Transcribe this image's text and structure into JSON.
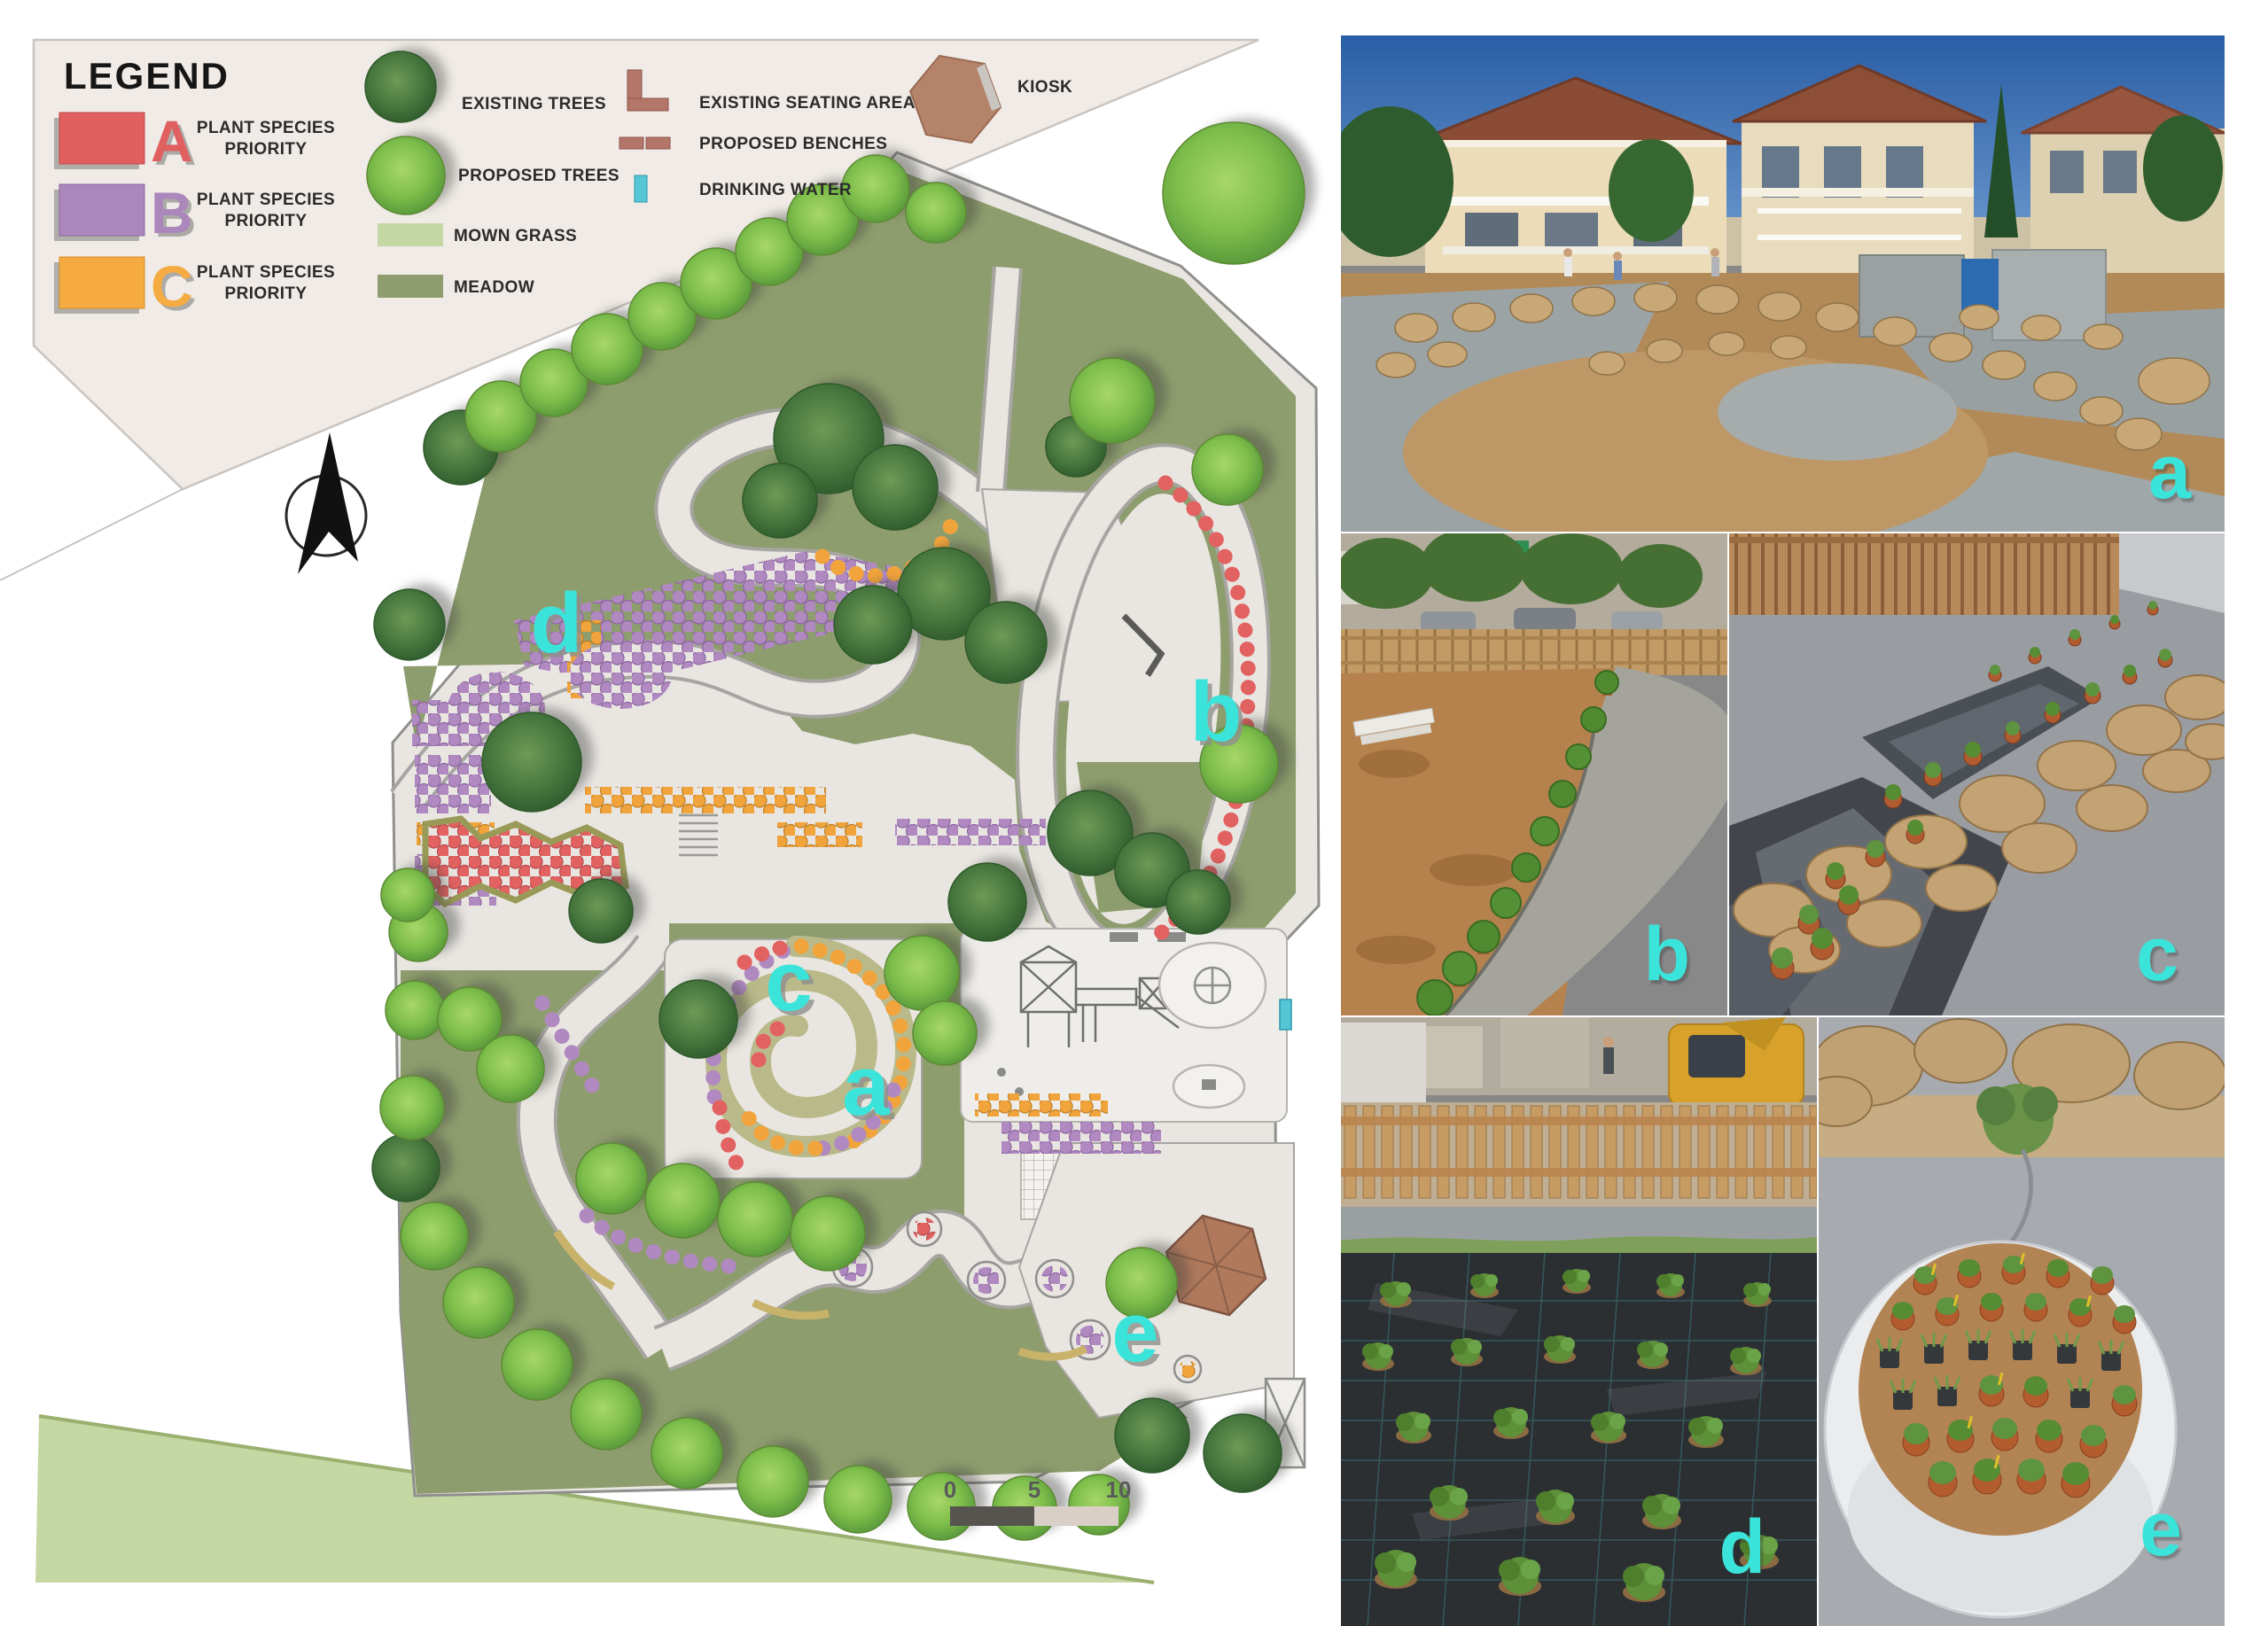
{
  "legend": {
    "title": "LEGEND",
    "plant_species": [
      {
        "letter": "A",
        "line1": "PLANT SPECIES",
        "line2": "PRIORITY",
        "color": "#e05f5f"
      },
      {
        "letter": "B",
        "line1": "PLANT SPECIES",
        "line2": "PRIORITY",
        "color": "#ab87bc"
      },
      {
        "letter": "C",
        "line1": "PLANT SPECIES",
        "line2": "PRIORITY",
        "color": "#f5ab41"
      }
    ],
    "existing_trees": "EXISTING TREES",
    "proposed_trees": "PROPOSED TREES",
    "mown_grass": "MOWN GRASS",
    "meadow": "MEADOW",
    "existing_seating_area": "EXISTING SEATING AREA",
    "proposed_benches": "PROPOSED BENCHES",
    "drinking_water": "DRINKING WATER",
    "kiosk": "KIOSK"
  },
  "plan": {
    "area_labels": [
      {
        "id": "a",
        "text": "a"
      },
      {
        "id": "b",
        "text": "b"
      },
      {
        "id": "c",
        "text": "c"
      },
      {
        "id": "d",
        "text": "d"
      },
      {
        "id": "e",
        "text": "e"
      }
    ],
    "scale_bar": {
      "ticks": [
        "0",
        "5",
        "10"
      ]
    }
  },
  "photos": [
    {
      "id": "a",
      "caption": "a"
    },
    {
      "id": "b",
      "caption": "b"
    },
    {
      "id": "c",
      "caption": "c"
    },
    {
      "id": "d",
      "caption": "d"
    },
    {
      "id": "e",
      "caption": "e"
    }
  ],
  "colors": {
    "priority_a": "#e05f5f",
    "priority_b": "#ab87bc",
    "priority_c": "#f5ab41",
    "mown_grass": "#c5d7a3",
    "meadow": "#8e9d6e",
    "label_cyan": "#3be4da",
    "kiosk_brown": "#b0795c",
    "drinking_water_cyan": "#55c6d6"
  }
}
